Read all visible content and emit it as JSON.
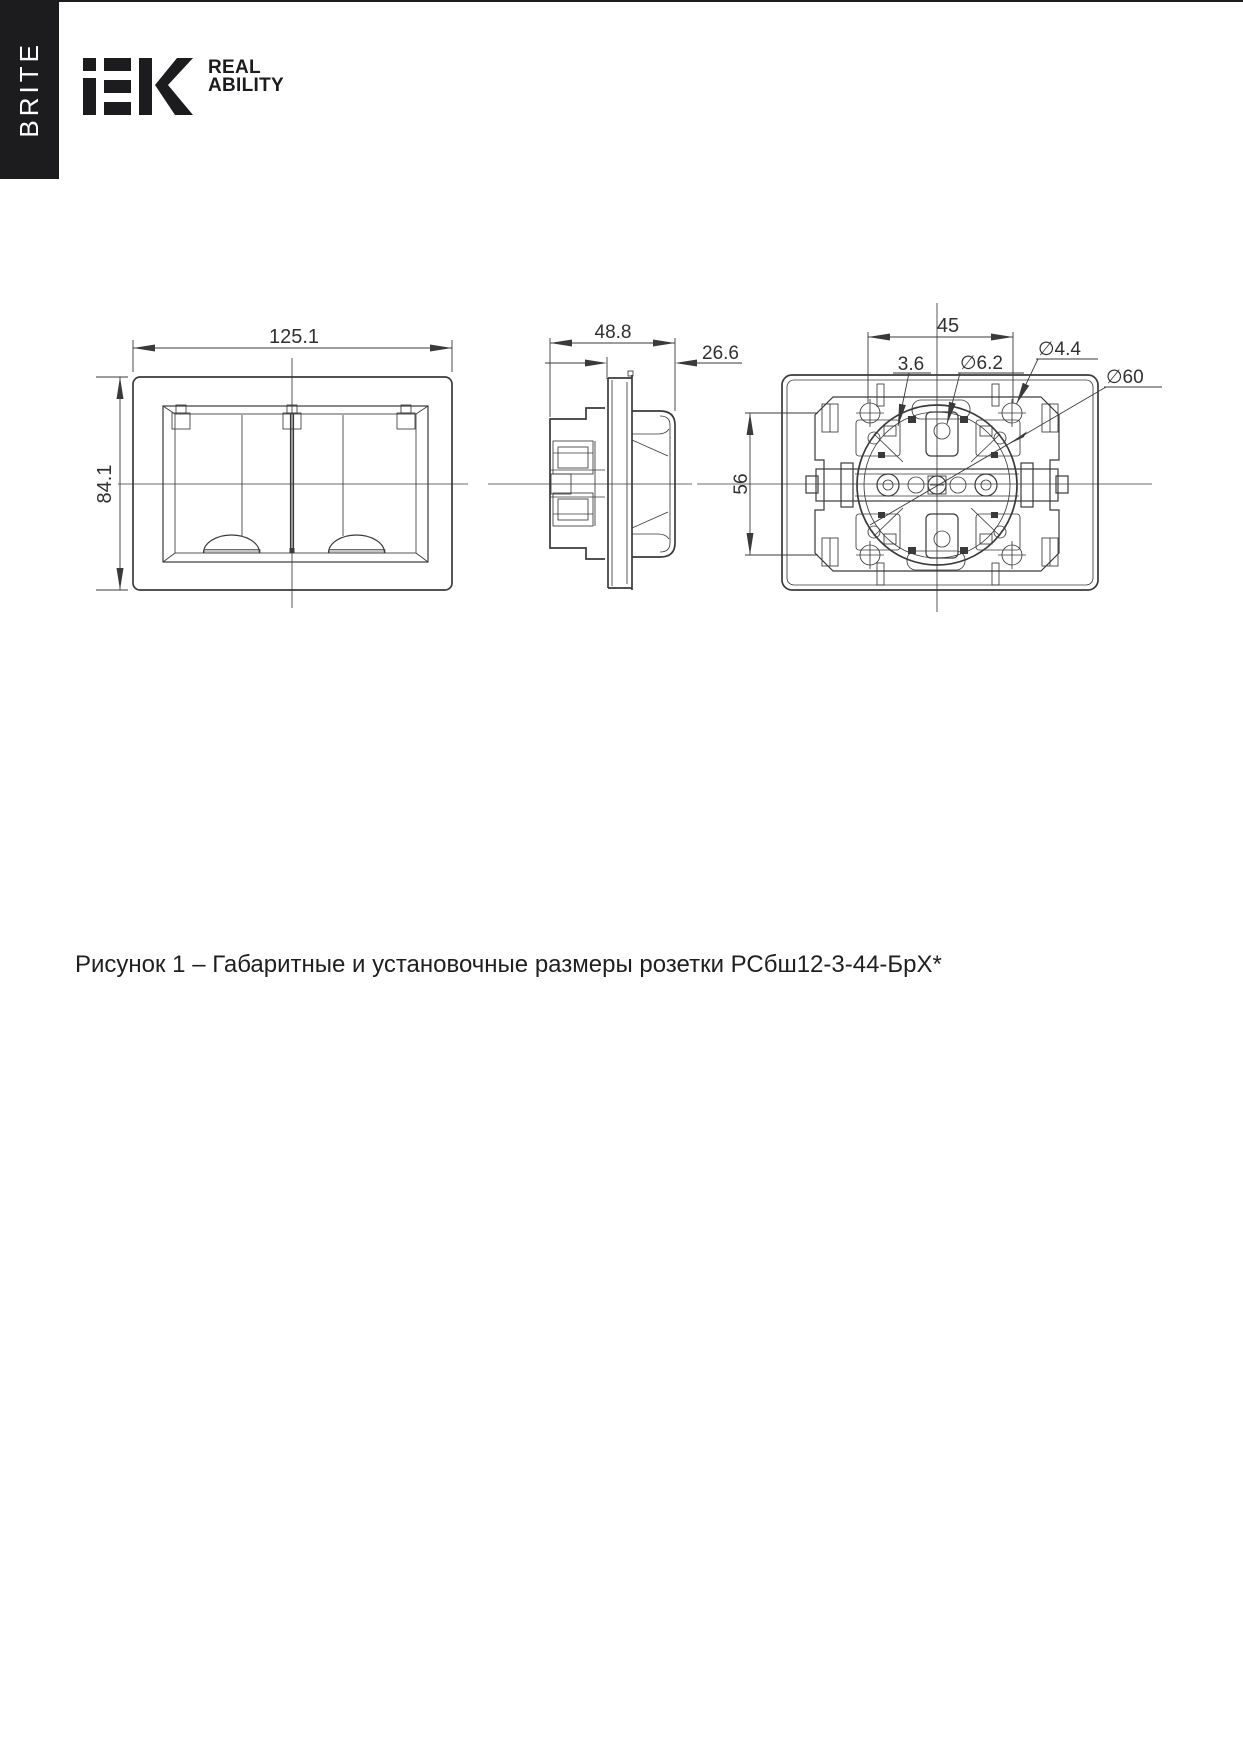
{
  "header": {
    "side_label": "BRITE",
    "brand_logo": "iEK",
    "tagline_line1": "REAL",
    "tagline_line2": "ABILITY"
  },
  "figure": {
    "caption": "Рисунок 1 – Габаритные и установочные размеры розетки РСбш12-3-44-БрХ*"
  },
  "dimensions": {
    "front_width": "125.1",
    "front_height": "84.1",
    "total_depth": "48.8",
    "front_depth": "26.6",
    "screw_spacing": "45",
    "slot_width": "3.6",
    "tab_hole_diameter": "∅6.2",
    "mount_hole_diameter": "∅4.4",
    "box_diameter": "∅60",
    "vertical_spacing": "56"
  },
  "colors": {
    "ink": "#3a3a3a",
    "banner": "#1c1c1e"
  }
}
